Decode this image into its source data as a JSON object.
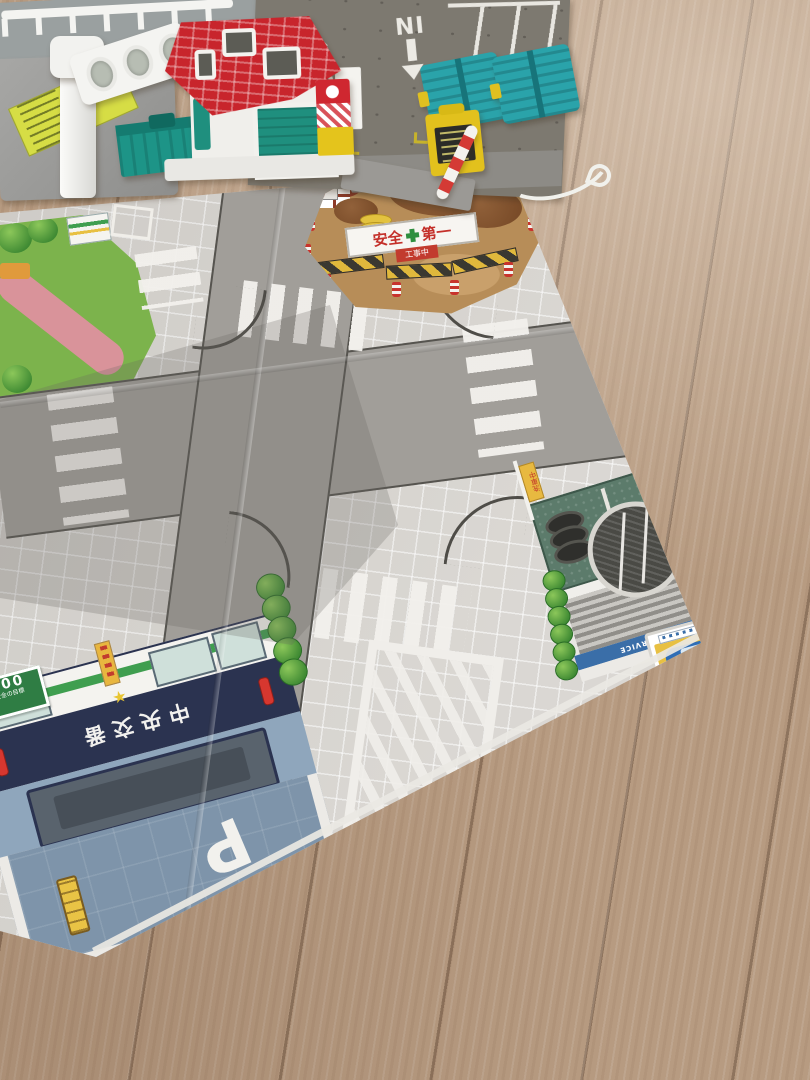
{
  "scene": {
    "description": "Photograph of a toy city play mat spread on a light oak wooden floor, with plastic toy buildings arranged along the top edge",
    "floor_color": "#b79b81",
    "mat_road_color": "#a19e99",
    "mat_sidewalk_color": "#d8d5d0"
  },
  "labels": {
    "deck_out": "OUT",
    "deck_in": "IN"
  },
  "construction": {
    "banner_left": "安全",
    "banner_right": "第一",
    "sub_sign": "工事中",
    "dirt_color": "#b78d58",
    "barricade_colors": [
      "#e0b83c",
      "#3a3831"
    ]
  },
  "police": {
    "sign_text": "中央交番",
    "star_icon": "★",
    "sign_bg": "#2b3350",
    "wall_color": "#8fa6bc",
    "parking_letter": "P",
    "parking_lot_color": "#7e94aa",
    "counter_sign_number": "000",
    "counter_sign_caption": "安全の目標",
    "counter_sign_color": "#2f7d44"
  },
  "carwash": {
    "band_text": "WASH SERVICE",
    "flag_text": "洗車中",
    "roof_color": "#5c7b6b",
    "band_color": "#3a6ea8",
    "sign_board_color": "#e8c042"
  },
  "toys": {
    "fire_station_roof_color": "#c8252c",
    "fire_station_door_color": "#1f8f7e",
    "dumpster_color": "#1d9487",
    "car_lift_color": "#2aa3aa",
    "gate_box_color": "#e2c11d",
    "deck_color": "#7d7970",
    "traffic_light_color": "#f2f2ef",
    "button_color": "#e01f26"
  }
}
